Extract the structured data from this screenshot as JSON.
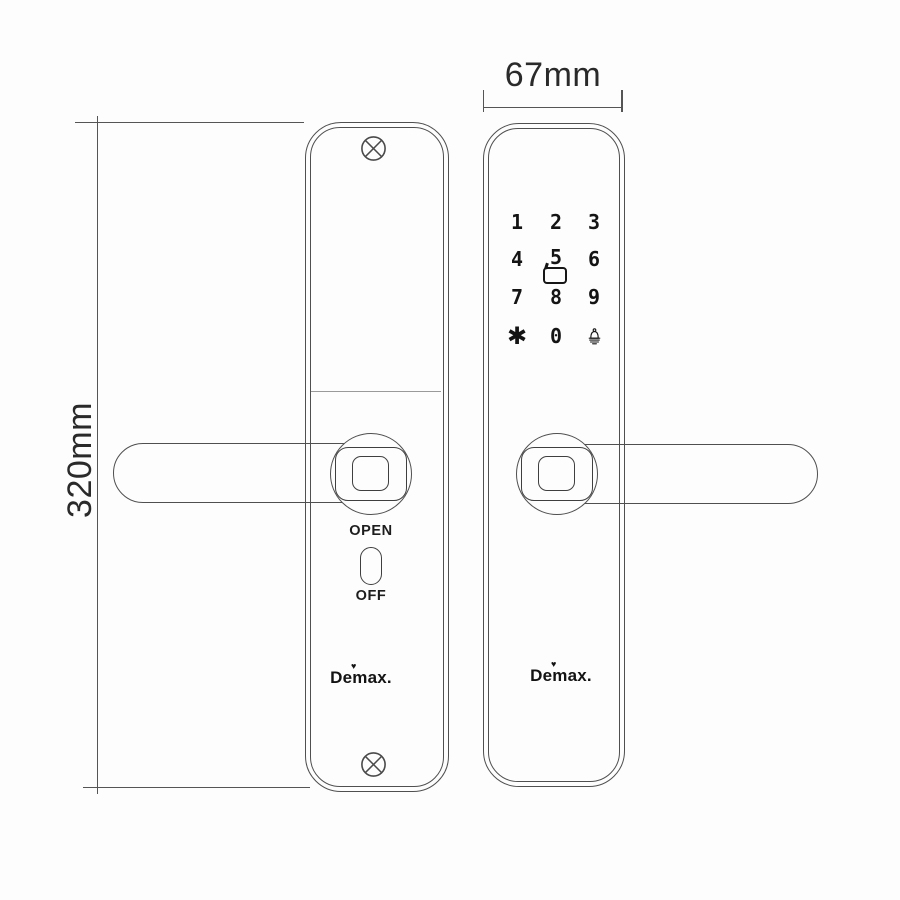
{
  "colors": {
    "line": "#4f4f4f",
    "dimension_line": "#555555",
    "ink": "#161616",
    "background": "#fdfdfd"
  },
  "dimension_labels": {
    "height": "320mm",
    "width": "67mm"
  },
  "back_view": {
    "toggle": {
      "top": "OPEN",
      "bottom": "OFF"
    },
    "brand": "Demax.",
    "brand_mark": "♥",
    "icons": {
      "top": "screw-cross-icon",
      "bottom": "screw-cross-icon"
    }
  },
  "front_view": {
    "keypad": {
      "keys": [
        "1",
        "2",
        "3",
        "4",
        "5",
        "6",
        "7",
        "8",
        "9",
        "✱",
        "0"
      ],
      "icons": [
        "rfid-card-icon",
        "doorbell-icon"
      ]
    },
    "brand": "Demax.",
    "brand_mark": "♥"
  }
}
